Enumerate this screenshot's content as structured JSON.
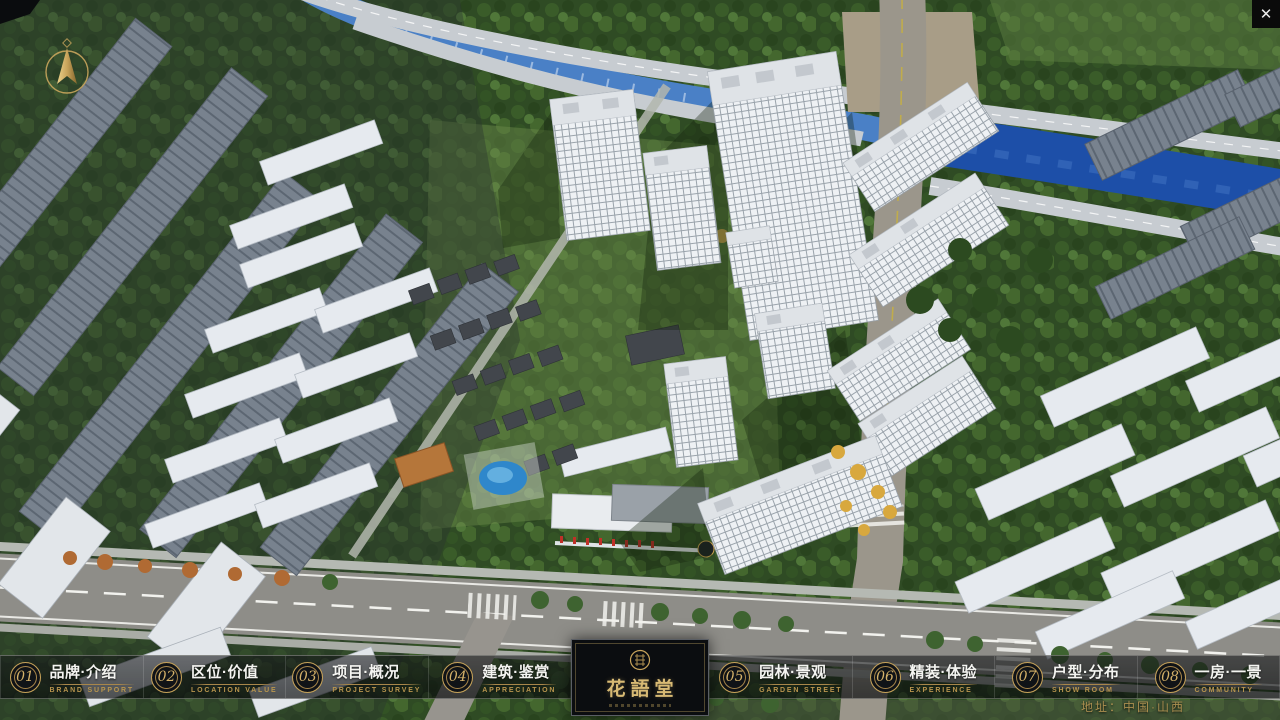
{
  "window": {
    "close_glyph": "✕"
  },
  "logo": {
    "title": "花語堂"
  },
  "nav": {
    "items": [
      {
        "num": "01",
        "zh": "品牌·介绍",
        "en": "BRAND SUPPORT"
      },
      {
        "num": "02",
        "zh": "区位·价值",
        "en": "LOCATION VALUE"
      },
      {
        "num": "03",
        "zh": "项目·概况",
        "en": "PROJECT SURVEY"
      },
      {
        "num": "04",
        "zh": "建筑·鉴赏",
        "en": "APPRECIATION"
      },
      {
        "num": "05",
        "zh": "园林·景观",
        "en": "GARDEN STREET"
      },
      {
        "num": "06",
        "zh": "精装·体验",
        "en": "EXPERIENCE"
      },
      {
        "num": "07",
        "zh": "户型·分布",
        "en": "SHOW ROOM"
      },
      {
        "num": "08",
        "zh": "一房·一景",
        "en": "COMMUNITY"
      }
    ]
  },
  "footer": {
    "address": "地址：中国·山西"
  },
  "colors": {
    "gold": "#c6a259",
    "bar_bg": "rgba(10,12,14,0.62)",
    "river": "#1d4fa8",
    "accent_text": "#b8954e"
  }
}
